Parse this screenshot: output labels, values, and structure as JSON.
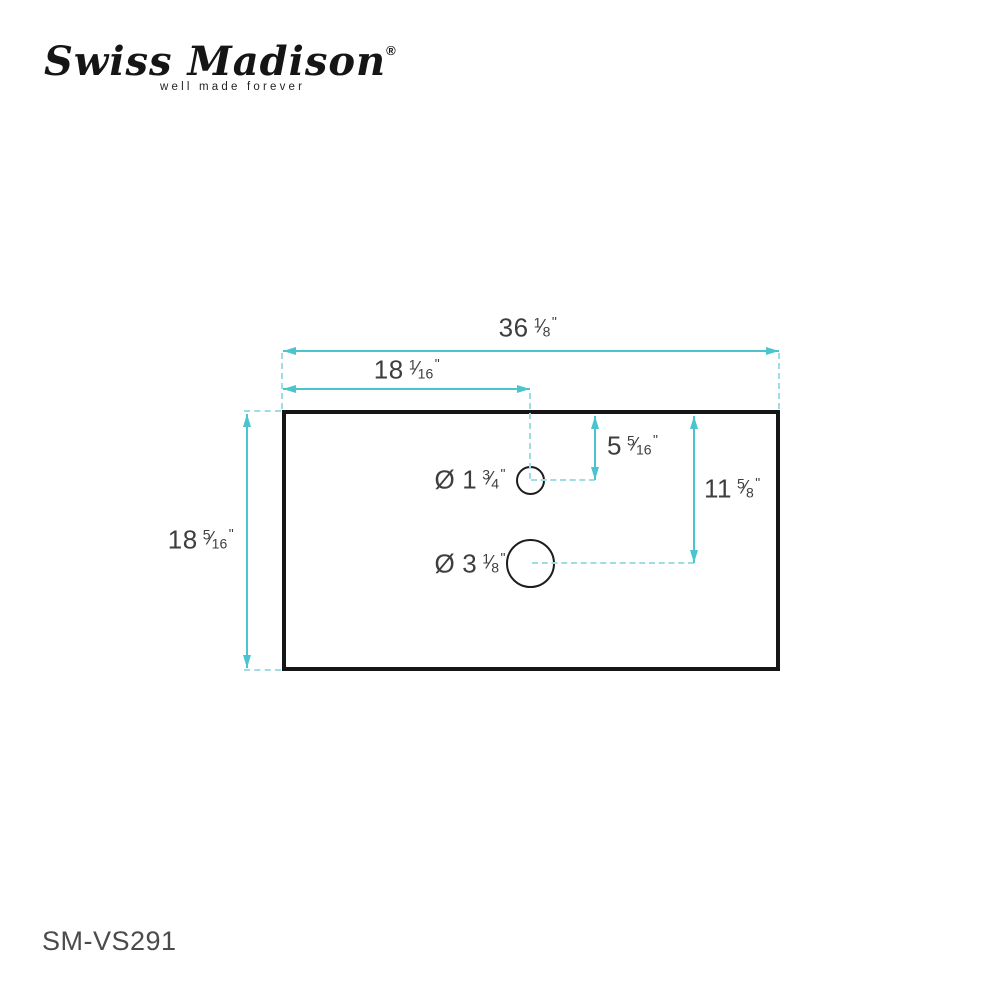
{
  "logo": {
    "brand": "Swiss Madison",
    "registered": "®",
    "tagline": "well made forever"
  },
  "footer": {
    "model": "SM-VS291"
  },
  "glyphs": {
    "fraction_slash": "⁄"
  },
  "colors": {
    "dimension_teal": "#4bc4ce",
    "extension_teal": "#9edde3",
    "outline_black": "#161616",
    "label_gray": "#3e3e3e"
  },
  "dimensions": {
    "overall_width": {
      "whole": "36",
      "num": "1",
      "den": "8",
      "unit": "\""
    },
    "hole_offset_x": {
      "whole": "18",
      "num": "1",
      "den": "16",
      "unit": "\""
    },
    "overall_depth": {
      "whole": "18",
      "num": "5",
      "den": "16",
      "unit": "\""
    },
    "small_hole_offset_y": {
      "whole": "5",
      "num": "5",
      "den": "16",
      "unit": "\""
    },
    "large_hole_offset_y": {
      "whole": "11",
      "num": "5",
      "den": "8",
      "unit": "\""
    },
    "small_hole_diameter": {
      "prefix": "Ø",
      "whole": "1",
      "num": "3",
      "den": "4",
      "unit": "\""
    },
    "large_hole_diameter": {
      "prefix": "Ø",
      "whole": "3",
      "num": "1",
      "den": "8",
      "unit": "\""
    }
  }
}
